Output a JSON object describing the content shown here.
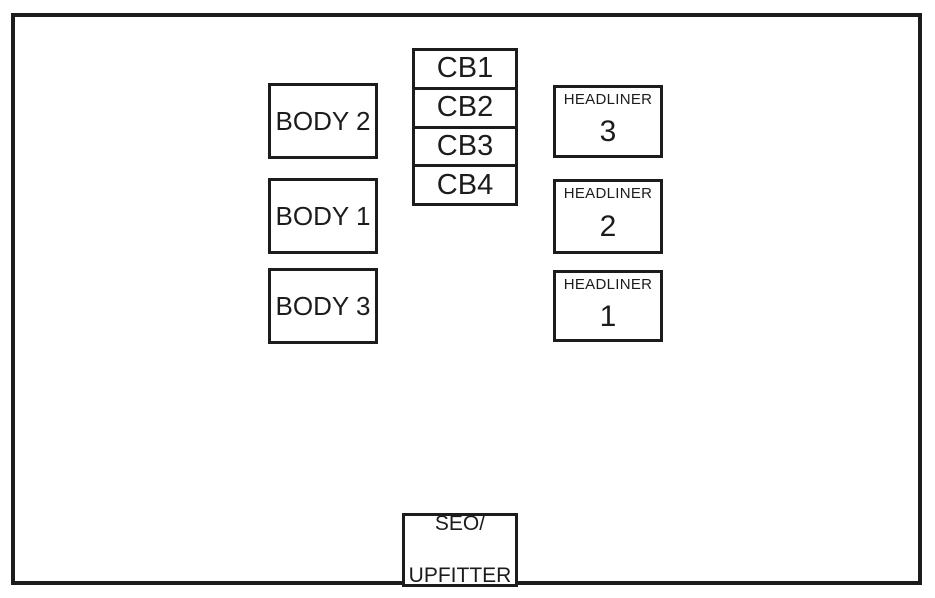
{
  "diagram": {
    "background_color": "#ffffff",
    "line_color": "#1c1c1c",
    "body_boxes": [
      {
        "label": "BODY 2"
      },
      {
        "label": "BODY 1"
      },
      {
        "label": "BODY 3"
      }
    ],
    "cb_cells": [
      {
        "label": "CB1"
      },
      {
        "label": "CB2"
      },
      {
        "label": "CB3"
      },
      {
        "label": "CB4"
      }
    ],
    "headliner_boxes": [
      {
        "title": "HEADLINER",
        "number": "3"
      },
      {
        "title": "HEADLINER",
        "number": "2"
      },
      {
        "title": "HEADLINER",
        "number": "1"
      }
    ],
    "seo_box": {
      "line1": "SEO/",
      "line2": "UPFITTER"
    }
  }
}
